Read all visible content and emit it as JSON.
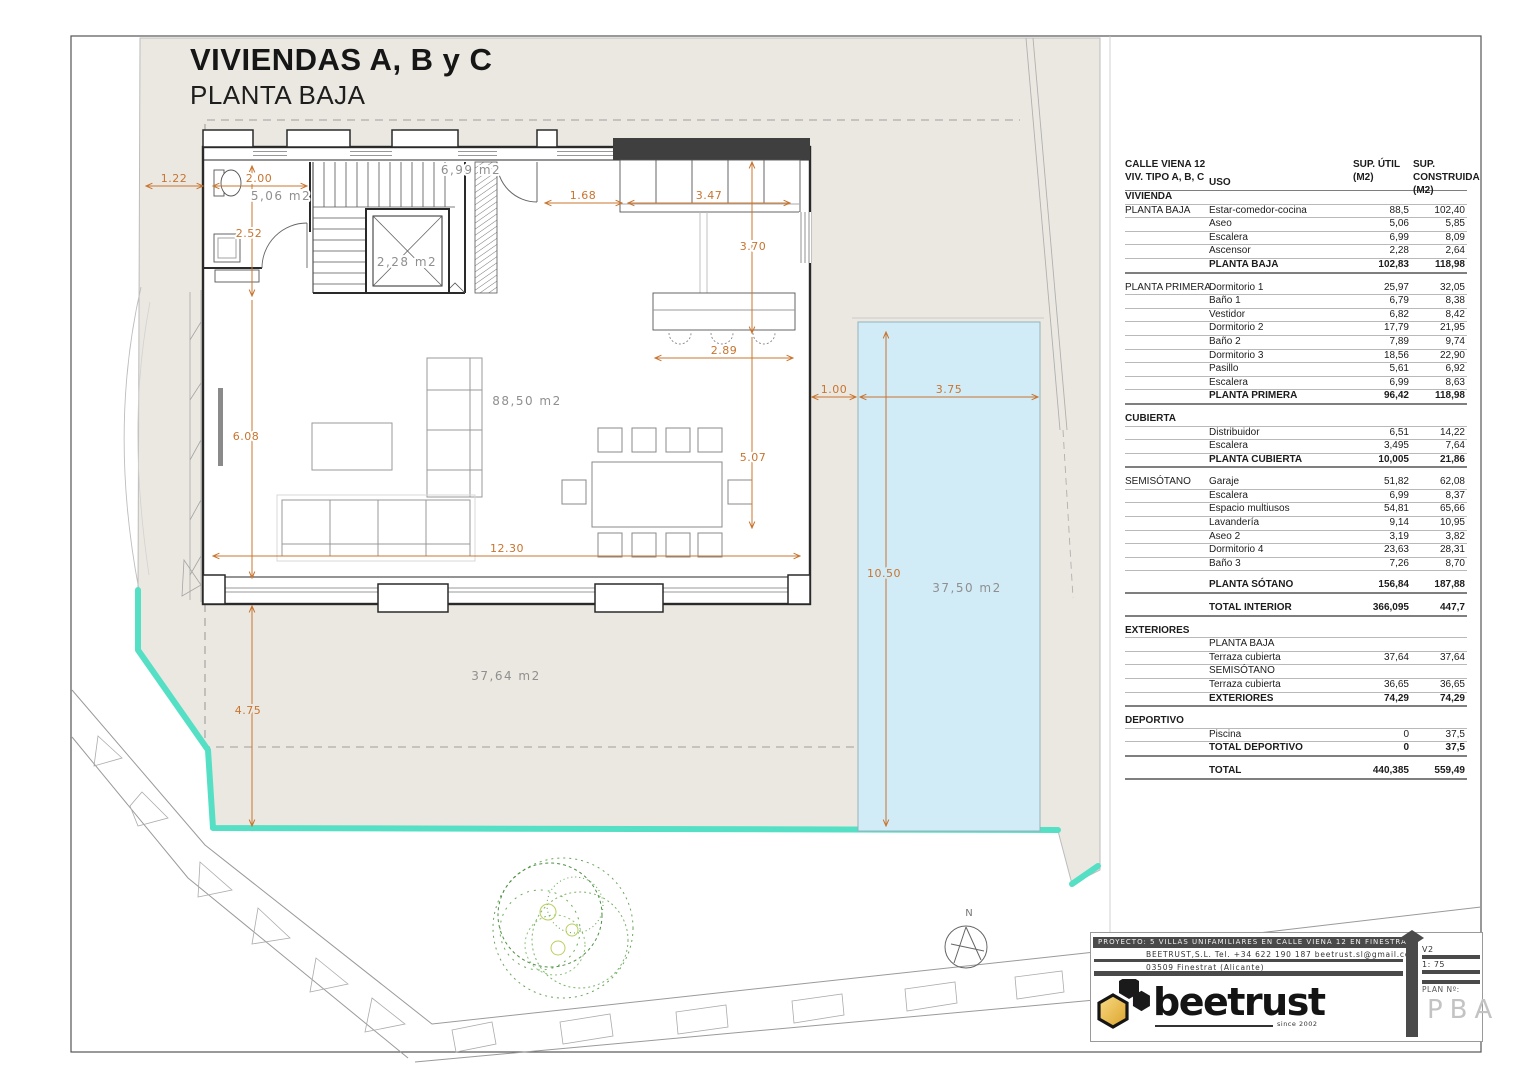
{
  "colors": {
    "accent_dim": "#c8742f",
    "plot_beige": "#ebe8e1",
    "pool_blue": "#d2ecf7",
    "boundary_teal": "#55dfc4",
    "wall_dark": "#2a2a2a",
    "logo_gold": "#e9b23c",
    "titleblock_dark": "#4a4a4a"
  },
  "drawing": {
    "title": "VIVIENDAS A, B y C",
    "subtitle": "PLANTA BAJA"
  },
  "plan": {
    "north_label": "N",
    "dims": {
      "d122": "1.22",
      "d200": "2.00",
      "d252": "2.52",
      "d608": "6.08",
      "d475": "4.75",
      "d1230": "12.30",
      "d168": "1.68",
      "d347": "3.47",
      "d370": "3.70",
      "d507": "5.07",
      "d289": "2.89",
      "d100": "1.00",
      "d375": "3.75",
      "d1050": "10.50"
    },
    "areas": {
      "aseo": "5,06 m2",
      "escalera": "6,99 m2",
      "ascensor": "2,28 m2",
      "salon": "88,50 m2",
      "terraza": "37,64 m2",
      "piscina": "37,50 m2"
    }
  },
  "table": {
    "header": {
      "c1": "CALLE VIENA 12\nVIV. TIPO A, B, C",
      "c2": "USO",
      "v1": "SUP. ÚTIL\n(M2)",
      "v2": "SUP. CONSTRUIDA\n(M2)"
    },
    "rows": [
      {
        "c1": "VIVIENDA",
        "bold1": true
      },
      {
        "c1": "PLANTA BAJA",
        "c2": "Estar-comedor-cocina",
        "v1": "88,5",
        "v2": "102,40"
      },
      {
        "c2": "Aseo",
        "v1": "5,06",
        "v2": "5,85"
      },
      {
        "c2": "Escalera",
        "v1": "6,99",
        "v2": "8,09"
      },
      {
        "c2": "Ascensor",
        "v1": "2,28",
        "v2": "2,64"
      },
      {
        "c2": "PLANTA BAJA",
        "v1": "102,83",
        "v2": "118,98",
        "bold": true
      },
      {
        "type": "gap"
      },
      {
        "c1": "PLANTA PRIMERA",
        "c2": "Dormitorio 1",
        "v1": "25,97",
        "v2": "32,05"
      },
      {
        "c2": "Baño 1",
        "v1": "6,79",
        "v2": "8,38"
      },
      {
        "c2": "Vestidor",
        "v1": "6,82",
        "v2": "8,42"
      },
      {
        "c2": "Dormitorio 2",
        "v1": "17,79",
        "v2": "21,95"
      },
      {
        "c2": "Baño 2",
        "v1": "7,89",
        "v2": "9,74"
      },
      {
        "c2": "Dormitorio 3",
        "v1": "18,56",
        "v2": "22,90"
      },
      {
        "c2": "Pasillo",
        "v1": "5,61",
        "v2": "6,92"
      },
      {
        "c2": "Escalera",
        "v1": "6,99",
        "v2": "8,63"
      },
      {
        "c2": "PLANTA PRIMERA",
        "v1": "96,42",
        "v2": "118,98",
        "bold": true
      },
      {
        "type": "gap"
      },
      {
        "c1": "CUBIERTA",
        "bold1": true
      },
      {
        "c2": "Distribuidor",
        "v1": "6,51",
        "v2": "14,22"
      },
      {
        "c2": "Escalera",
        "v1": "3,495",
        "v2": "7,64"
      },
      {
        "c2": "PLANTA CUBIERTA",
        "v1": "10,005",
        "v2": "21,86",
        "bold": true
      },
      {
        "type": "gap"
      },
      {
        "c1": "SEMISÓTANO",
        "c2": "Garaje",
        "v1": "51,82",
        "v2": "62,08"
      },
      {
        "c2": "Escalera",
        "v1": "6,99",
        "v2": "8,37"
      },
      {
        "c2": "Espacio multiusos",
        "v1": "54,81",
        "v2": "65,66"
      },
      {
        "c2": "Lavandería",
        "v1": "9,14",
        "v2": "10,95"
      },
      {
        "c2": "Aseo 2",
        "v1": "3,19",
        "v2": "3,82"
      },
      {
        "c2": "Dormitorio 4",
        "v1": "23,63",
        "v2": "28,31"
      },
      {
        "c2": "Baño 3",
        "v1": "7,26",
        "v2": "8,70"
      },
      {
        "type": "gap"
      },
      {
        "c2": "PLANTA SÓTANO",
        "v1": "156,84",
        "v2": "187,88",
        "bold": true
      },
      {
        "type": "gap"
      },
      {
        "c2": "TOTAL INTERIOR",
        "v1": "366,095",
        "v2": "447,7",
        "bold": true
      },
      {
        "type": "gap"
      },
      {
        "c1": "EXTERIORES",
        "bold1": true
      },
      {
        "c2": "PLANTA BAJA"
      },
      {
        "c2": "Terraza cubierta",
        "v1": "37,64",
        "v2": "37,64"
      },
      {
        "c2": "SEMISÓTANO"
      },
      {
        "c2": "Terraza cubierta",
        "v1": "36,65",
        "v2": "36,65"
      },
      {
        "c2": "EXTERIORES",
        "v1": "74,29",
        "v2": "74,29",
        "bold": true
      },
      {
        "type": "gap"
      },
      {
        "c1": "DEPORTIVO",
        "bold1": true
      },
      {
        "c2": "Piscina",
        "v1": "0",
        "v2": "37,5"
      },
      {
        "c2": "TOTAL DEPORTIVO",
        "v1": "0",
        "v2": "37,5",
        "bold": true
      },
      {
        "type": "gap"
      },
      {
        "c2": "TOTAL",
        "v1": "440,385",
        "v2": "559,49",
        "bold": true
      }
    ]
  },
  "titleblock": {
    "project": "PROYECTO:  5  VILLAS  UNIFAMILIARES  EN  CALLE  VIENA  12  EN  FINESTRAT",
    "contact": "BEETRUST,S.L.   Tel.  +34  622  190  187     beetrust.sl@gmail.com",
    "address": "03509  Finestrat  (Alicante)",
    "logo_text": "beetrust",
    "logo_tagline": "since 2002",
    "version": "V2",
    "scale": "1: 75",
    "plan_label": "PLAN  Nº:",
    "plan_number": "PBA"
  }
}
